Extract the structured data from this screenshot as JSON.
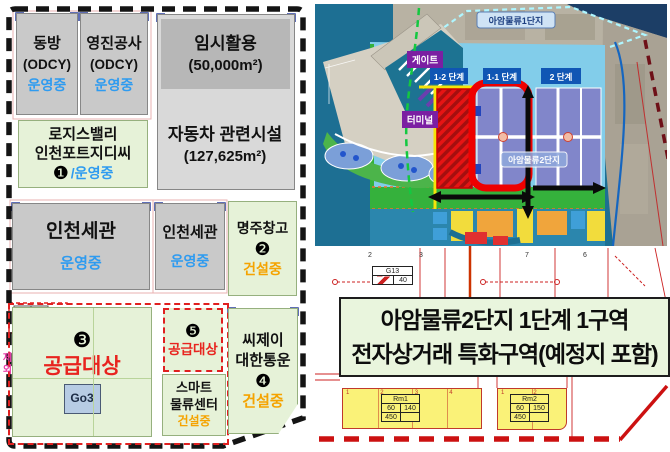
{
  "left_panel": {
    "dongbang": {
      "name": "동방",
      "sub": "(ODCY)",
      "status": "운영중"
    },
    "youngjin": {
      "name": "영진공사",
      "sub": "(ODCY)",
      "status": "운영중"
    },
    "logisvalley": {
      "line1": "로지스밸리",
      "line2": "인천포트지디씨",
      "badge": "❶",
      "status": "/운영중"
    },
    "temp_use": {
      "line1": "임시활용",
      "line2": "(50,000m²)"
    },
    "auto_facility": {
      "line1": "자동차 관련시설",
      "line2": "(127,625m²)"
    },
    "customs1": {
      "name": "인천세관",
      "status": "운영중"
    },
    "customs2": {
      "name": "인천세관",
      "status": "운영중"
    },
    "myeongju": {
      "name": "명주창고",
      "badge": "❷",
      "status": "건설중"
    },
    "supply3": {
      "badge": "❸",
      "label": "공급대상",
      "tag": "Go3"
    },
    "supply5": {
      "badge": "❺",
      "label": "공급대상"
    },
    "smart": {
      "line1": "스마트",
      "line2": "물류센터",
      "status": "건설중"
    },
    "cj": {
      "line1": "씨제이",
      "line2": "대한통운",
      "badge": "❹",
      "status": "건설중"
    },
    "excluded_label": "제외",
    "mini_table": {
      "c1": "70",
      "c2": "4"
    },
    "faint_table": {
      "r1c1": "70",
      "r1c2": "40",
      "r2c1": "1.00",
      "r2c2": "-"
    }
  },
  "map": {
    "labels": {
      "complex1": "아암물류1단지",
      "gate": "게이트",
      "terminal": "터미널",
      "phase12": "1-2 단계",
      "phase11": "1-1 단계",
      "phase2": "2 단계",
      "complex2": "아암물류2단지"
    },
    "colors": {
      "ocean": "#1d6f93",
      "land_blue": "#82cdea",
      "block_purple": "#8186ca",
      "green_strip": "#35b13c",
      "red_outline": "#ee0000",
      "hatch_red": "#e61414",
      "phase_label_bg": "#1056b4",
      "gate_bg": "#7b1fa2"
    }
  },
  "title_box": {
    "line1": "아암물류2단지 1단계 1구역",
    "line2": "전자상거래 특화구역(예정지 포함)"
  },
  "cad": {
    "strip_numbers": [
      "2",
      "3",
      "7",
      "6"
    ],
    "g13_table": {
      "c1": "G13",
      "c2": "40"
    },
    "rm1": {
      "title": "Rm1",
      "r1c1": "60",
      "r1c2": "140",
      "r2c1": "450",
      "r2c2": ""
    },
    "rm2": {
      "title": "Rm2",
      "r1c1": "60",
      "r1c2": "150",
      "r2c1": "450",
      "r2c2": ""
    },
    "block1_numbers": [
      "1",
      "2",
      "3",
      "4"
    ],
    "block2_numbers": [
      "1",
      "2"
    ]
  }
}
